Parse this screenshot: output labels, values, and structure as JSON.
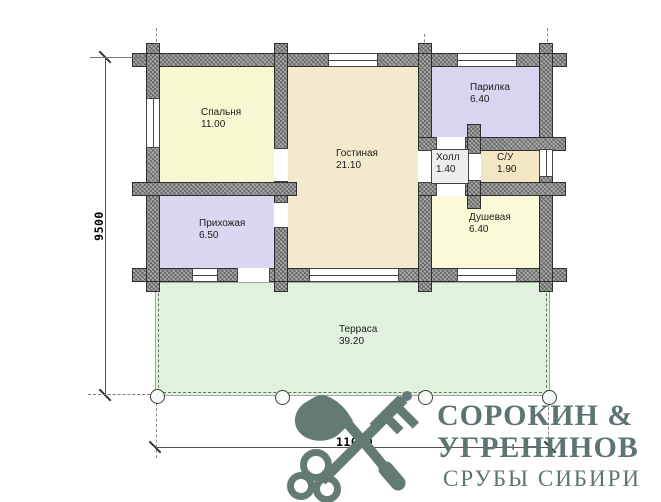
{
  "plan": {
    "rooms": {
      "bedroom": {
        "name": "Спальня",
        "area": "11.00"
      },
      "living": {
        "name": "Гостиная",
        "area": "21.10"
      },
      "steam": {
        "name": "Парилка",
        "area": "6.40"
      },
      "hall": {
        "name": "Холл",
        "area": "1.40"
      },
      "wc": {
        "name": "С/У",
        "area": "1.90"
      },
      "shower": {
        "name": "Душевая",
        "area": "6.40"
      },
      "entry": {
        "name": "Прихожая",
        "area": "6.50"
      },
      "terrace": {
        "name": "Терраса",
        "area": "39.20"
      }
    },
    "dimensions": {
      "height_mm": "9500",
      "width_mm": "11000"
    }
  },
  "logo": {
    "line1": "СОРОКИН &",
    "line2": "УГРЕНИНОВ",
    "line3": "СРУБЫ СИБИРИ",
    "icon": "axe-and-key-icon"
  },
  "colors": {
    "bedroom": "#f7f7d2",
    "entry": "#dbd7f3",
    "living": "#f3e9cd",
    "steam": "#dbd4f1",
    "hall": "#ededed",
    "wc": "#f3e6c2",
    "shower": "#fafad8",
    "terrace": "#e0f1dd",
    "wall": "#a9a9a9",
    "logo_icon": "#647a74",
    "logo_text": "#5e7472"
  }
}
